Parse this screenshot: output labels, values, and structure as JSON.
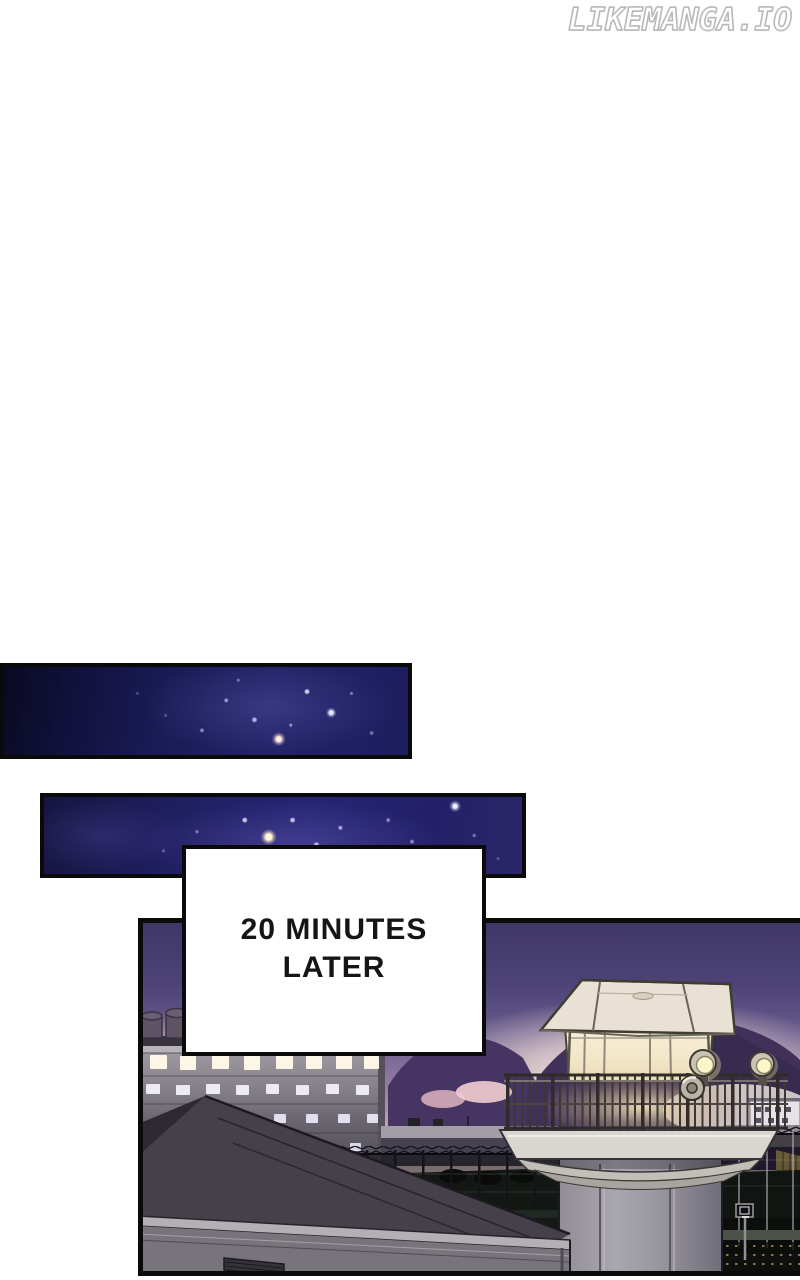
{
  "watermark": {
    "text": "LIKEMANGA.IO"
  },
  "caption_box": {
    "line1": "20 MINUTES",
    "line2": "LATER"
  },
  "panels": {
    "night_sky_1": {
      "label": "Dark starry night sky panel"
    },
    "night_sky_2": {
      "label": "Dark starry night sky panel with bright star cluster"
    },
    "prison_scene": {
      "label": "Prison complex at dusk: glowing glass watchtower on concrete pillar, cell block with rows of lit windows, storage tanks, perimeter fences with barbed wire, basketball hoop and dark courtyard under a purple sunset sky"
    }
  },
  "colors": {
    "page_background": "#ffffff",
    "panel_border": "#0a0a0a",
    "night_sky_blue": "#212266",
    "dusk_sky_top": "#3f3766",
    "dusk_horizon_glow": "#f7e8e3",
    "mountain_purple": "#413059",
    "window_glow": "#fdf6e6",
    "caption_text": "#151515",
    "watermark_outline": "#b9b9b9"
  }
}
